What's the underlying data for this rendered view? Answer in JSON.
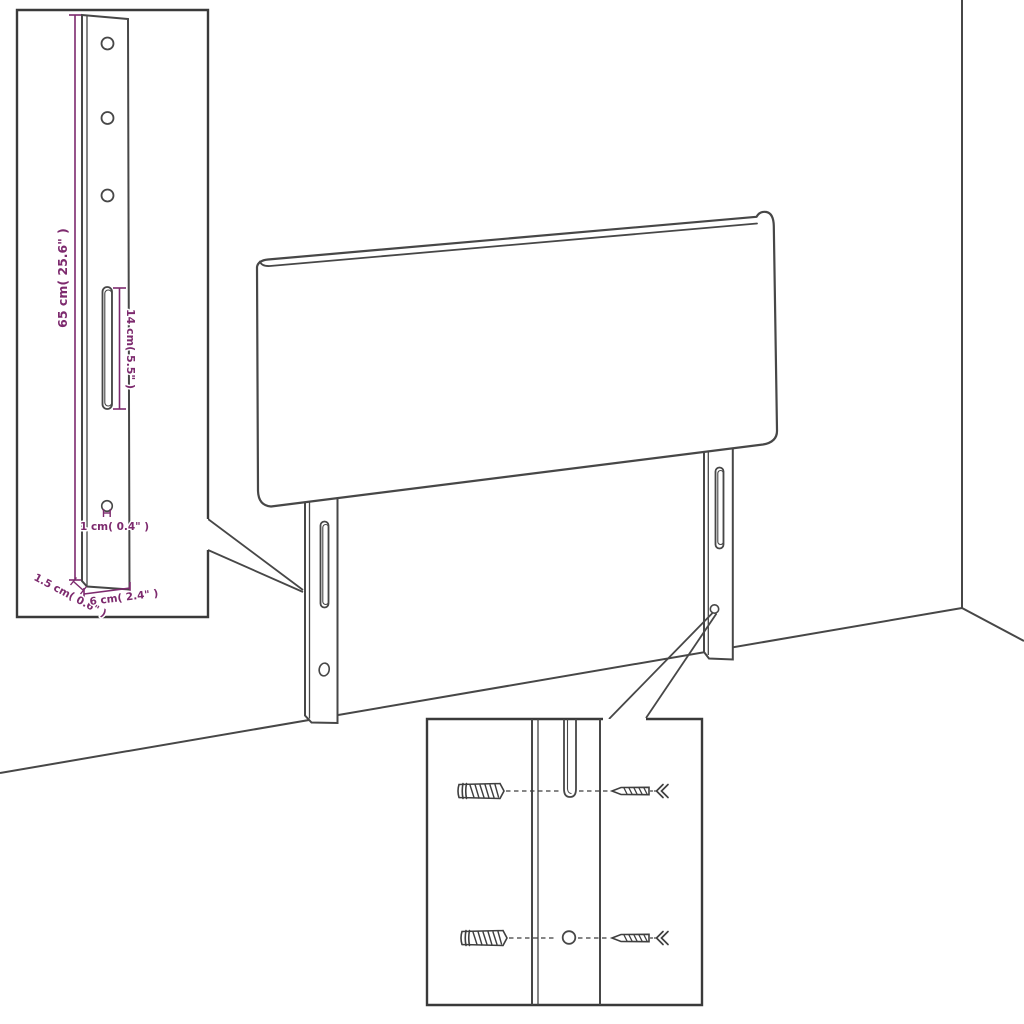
{
  "figure": {
    "type": "assembly-diagram",
    "subject": "upholstered headboard with mounting legs, bracket dimension inset and wall-fixing hardware inset",
    "colors": {
      "background": "#ffffff",
      "line": "#474747",
      "inset_border": "#3a3a3a",
      "dimension_accent": "#7d2a6e"
    },
    "bracket_inset": {
      "dim_height": "65 cm( 25.6\" )",
      "dim_slot": "14 cm( 5.5\" )",
      "dim_hole": "1 cm( 0.4\" )",
      "dim_thickness": "1.5 cm( 0.6\" )",
      "dim_width": "6 cm( 2.4\" )",
      "holes_count": 3
    },
    "hardware_inset": {
      "items": [
        "wall-plug",
        "screw",
        "wall-plug",
        "screw"
      ],
      "rows": 2
    }
  }
}
